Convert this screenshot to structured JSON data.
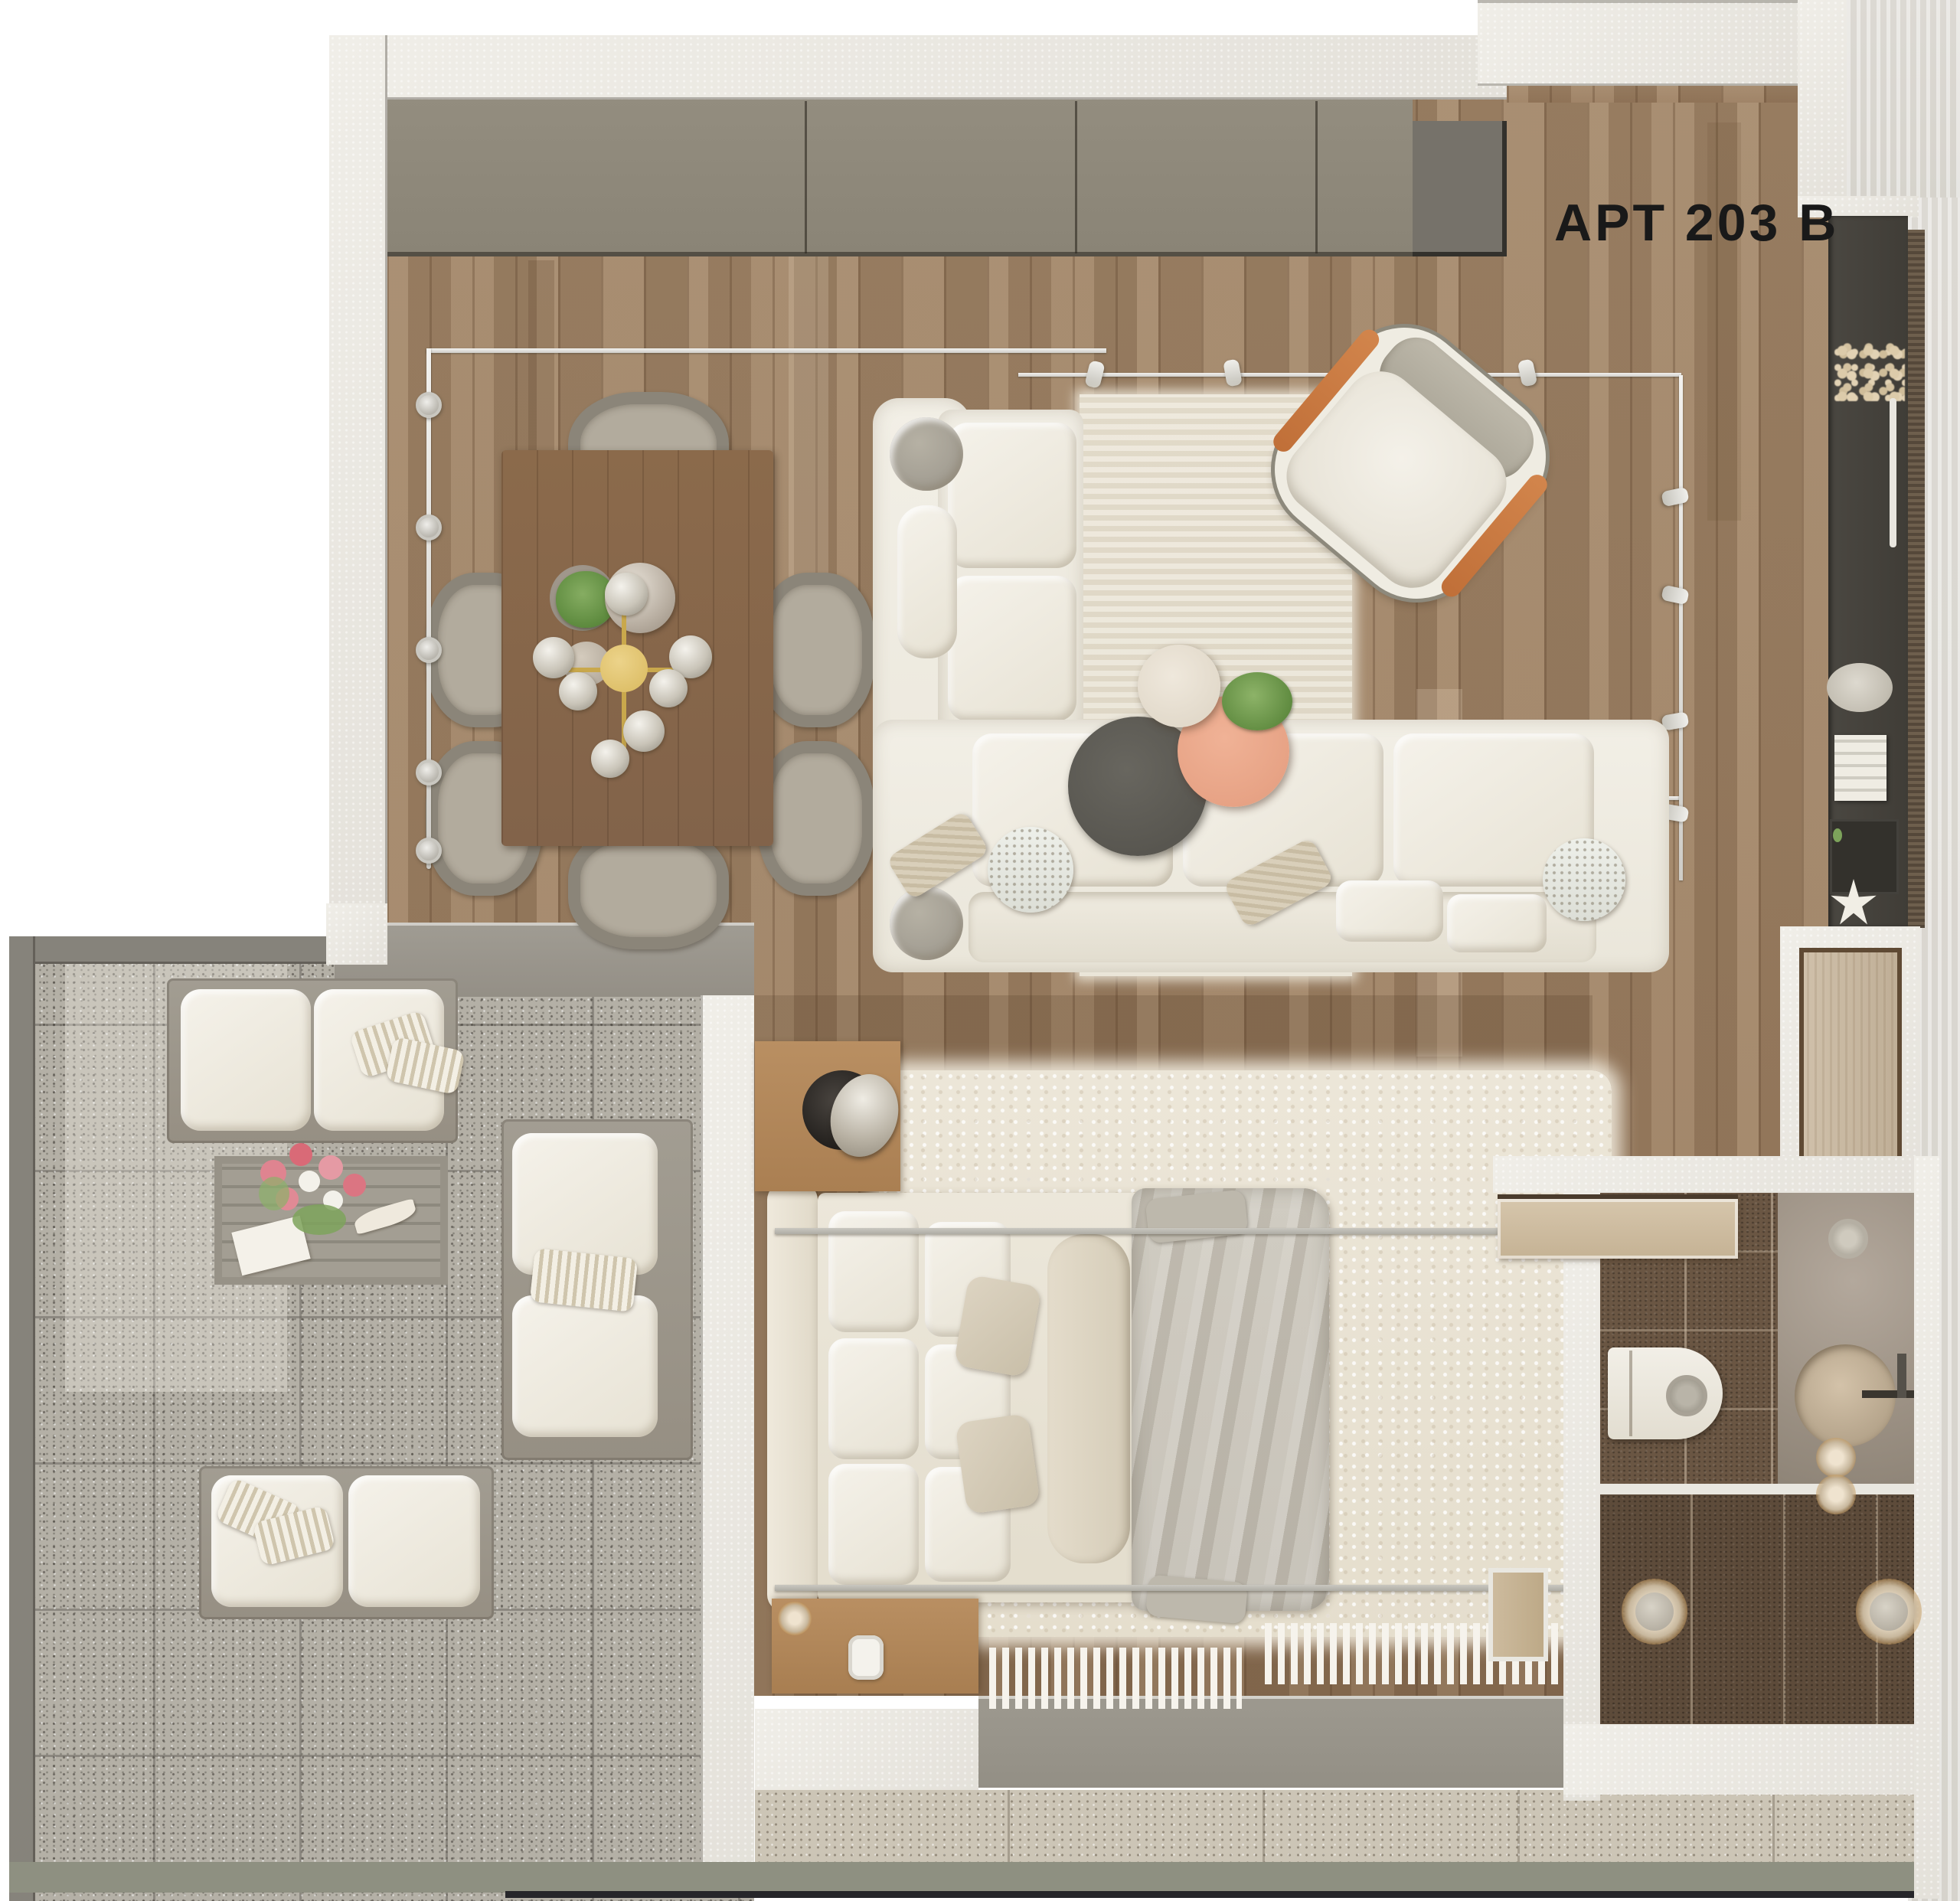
{
  "title": {
    "label": "APT 203 B"
  },
  "palette": {
    "background": "#ffffff",
    "outside_right": "#dcd9d3",
    "wall": "#eceae3",
    "wood_floor": "#9e8265",
    "cabinet_taupe": "#8f897b",
    "entry_cabinet_gray": "#76726a",
    "balcony_terrazzo": "#b4b0a6",
    "balcony_railing": "#86837b",
    "bottom_terrazzo": "#ccc5b6",
    "bottom_band_green": "#8e9081",
    "sofa_cream": "#f0ecdf",
    "armchair_orange": "#c9783f",
    "coffee_table_dark": "#5d5b55",
    "coffee_table_peach": "#e9a587",
    "kitchen_counter_dark": "#45423c",
    "bath_tile_brown": "#6a5643",
    "bed_duvet_gray": "#c7c2b7",
    "rug_cream": "#e9e3d4",
    "chandelier_gold": "#c9a84c",
    "title_text": "#191919"
  },
  "objects": {
    "rooms": [
      "living-dining-area",
      "kitchen-console",
      "entry",
      "bedroom",
      "bathroom",
      "balcony"
    ],
    "furniture": [
      "dining-table",
      "dining-chairs",
      "chandelier",
      "l-shaped-sofa",
      "coffee-table-set",
      "armchair",
      "track-lights",
      "kitchen-console",
      "double-bed",
      "nightstands",
      "canopy-rails",
      "fluffy-rug",
      "fringe-mats",
      "toilet",
      "vanity-sink",
      "sliding-door",
      "outdoor-sofas",
      "outdoor-coffee-table",
      "flower-bouquet",
      "starfish-decor"
    ]
  }
}
